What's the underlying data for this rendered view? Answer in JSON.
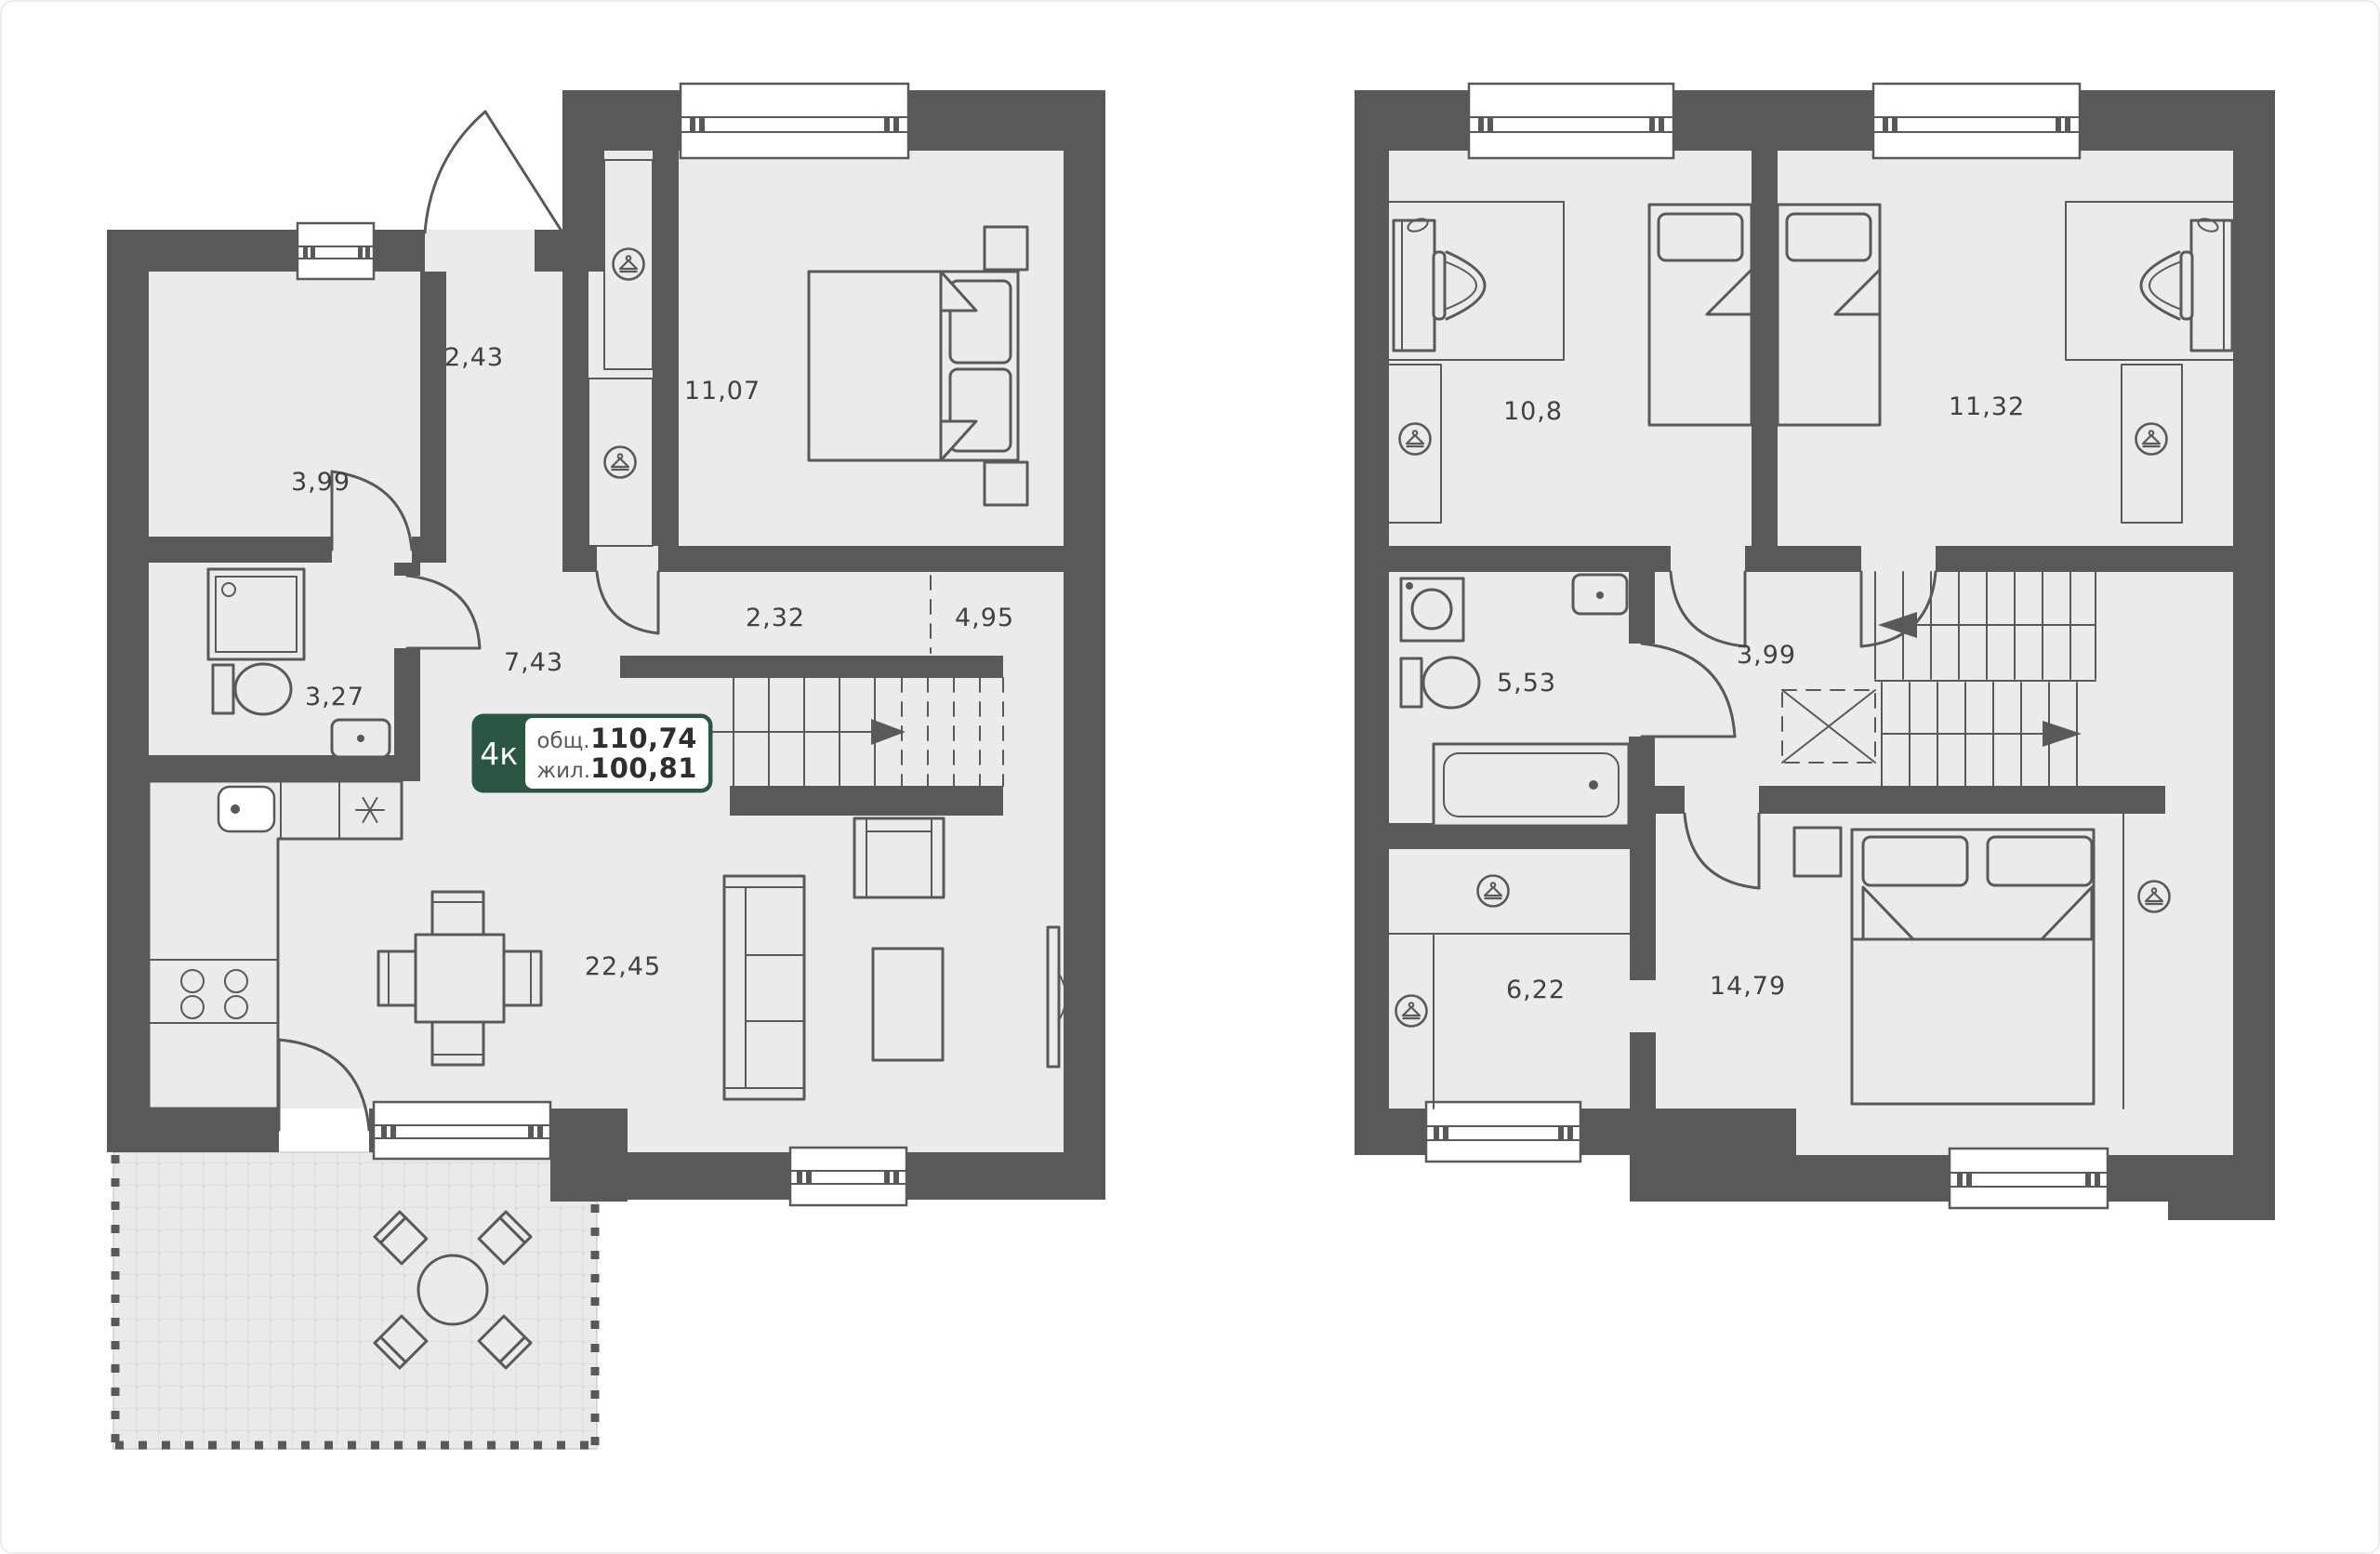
{
  "page": {
    "background": "#ffffff",
    "border_color": "#ececec"
  },
  "badge": {
    "rooms_label": "4к",
    "total_label": "общ.",
    "total_value": "110,74",
    "living_label": "жил.",
    "living_value": "100,81",
    "accent_color": "#2b5742"
  },
  "colors": {
    "wall": "#58595b",
    "floor": "#ebebeb",
    "line": "#58595b",
    "label_text": "#414042",
    "terrace_tile": "#eaeaea"
  },
  "icons": [
    {
      "name": "wardrobe-hanger-icon",
      "meaning": "wardrobe / clothes hanger in circle"
    }
  ],
  "plans": [
    {
      "id": "first-floor",
      "rooms": [
        {
          "id": "room-left",
          "area": "3,99"
        },
        {
          "id": "entry-hall",
          "area": "2,43"
        },
        {
          "id": "bedroom",
          "area": "11,07"
        },
        {
          "id": "bathroom",
          "area": "3,27"
        },
        {
          "id": "hallway",
          "area": "7,43"
        },
        {
          "id": "stair-corridor",
          "area": "2,32"
        },
        {
          "id": "under-stairs",
          "area": "4,95"
        },
        {
          "id": "kitchen-living",
          "area": "22,45"
        }
      ]
    },
    {
      "id": "second-floor",
      "rooms": [
        {
          "id": "bedroom-left",
          "area": "10,8"
        },
        {
          "id": "bedroom-right",
          "area": "11,32"
        },
        {
          "id": "bathroom",
          "area": "5,53"
        },
        {
          "id": "hallway",
          "area": "3,99"
        },
        {
          "id": "wardrobe-room",
          "area": "6,22"
        },
        {
          "id": "master-bedroom",
          "area": "14,79"
        }
      ]
    }
  ]
}
